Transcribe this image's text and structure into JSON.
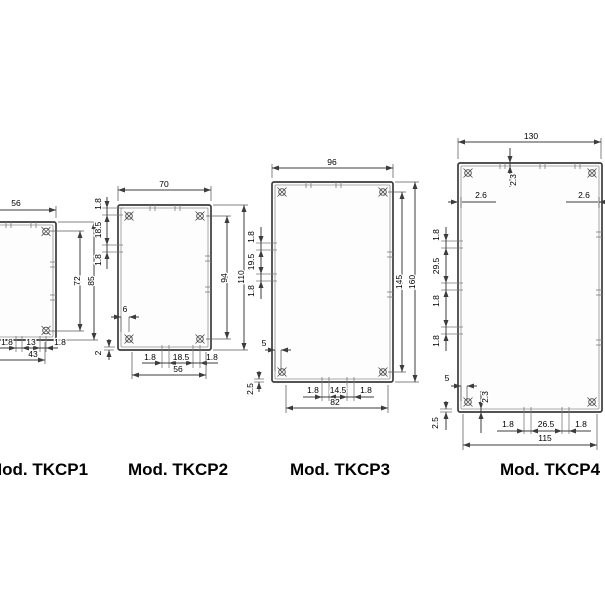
{
  "colors": {
    "line": "#3c3c3c",
    "text": "#000000",
    "background": "#ffffff"
  },
  "drawings": [
    {
      "model": "Mod. TKCP1",
      "dims": {
        "width": "56",
        "height_inner": "72",
        "height_outer": "85",
        "bottom_left": "1.8",
        "bottom_center": "13",
        "bottom_right": "1.8",
        "bottom_span": "43"
      }
    },
    {
      "model": "Mod. TKCP2",
      "dims": {
        "width": "70",
        "side_top": "1.8",
        "side_mid": "18.5",
        "side_bottom": "1.8",
        "height_inner": "94",
        "height_outer": "110",
        "post_offset": "6",
        "wall": "2",
        "bottom_left": "1.8",
        "bottom_center": "18.5",
        "bottom_right": "1.8",
        "bottom_span": "56"
      }
    },
    {
      "model": "Mod. TKCP3",
      "dims": {
        "width": "96",
        "side_top": "1.8",
        "side_mid": "19.5",
        "side_bottom": "1.8",
        "height_inner": "145",
        "height_outer": "160",
        "post_offset": "5",
        "wall": "2.5",
        "bottom_left": "1.8",
        "bottom_center": "14.5",
        "bottom_right": "1.8",
        "bottom_span": "82"
      }
    },
    {
      "model": "Mod. TKCP4",
      "dims": {
        "width": "130",
        "top_wall": "2.3",
        "corner_left": "2.6",
        "corner_right": "2.6",
        "side_1": "1.8",
        "side_2": "29.5",
        "side_3": "1.8",
        "side_4": "1.8",
        "post_offset": "5",
        "bottom_wall": "2.3",
        "wall": "2.5",
        "bottom_left": "1.8",
        "bottom_center": "26.5",
        "bottom_right": "1.8",
        "bottom_span": "115"
      }
    }
  ]
}
